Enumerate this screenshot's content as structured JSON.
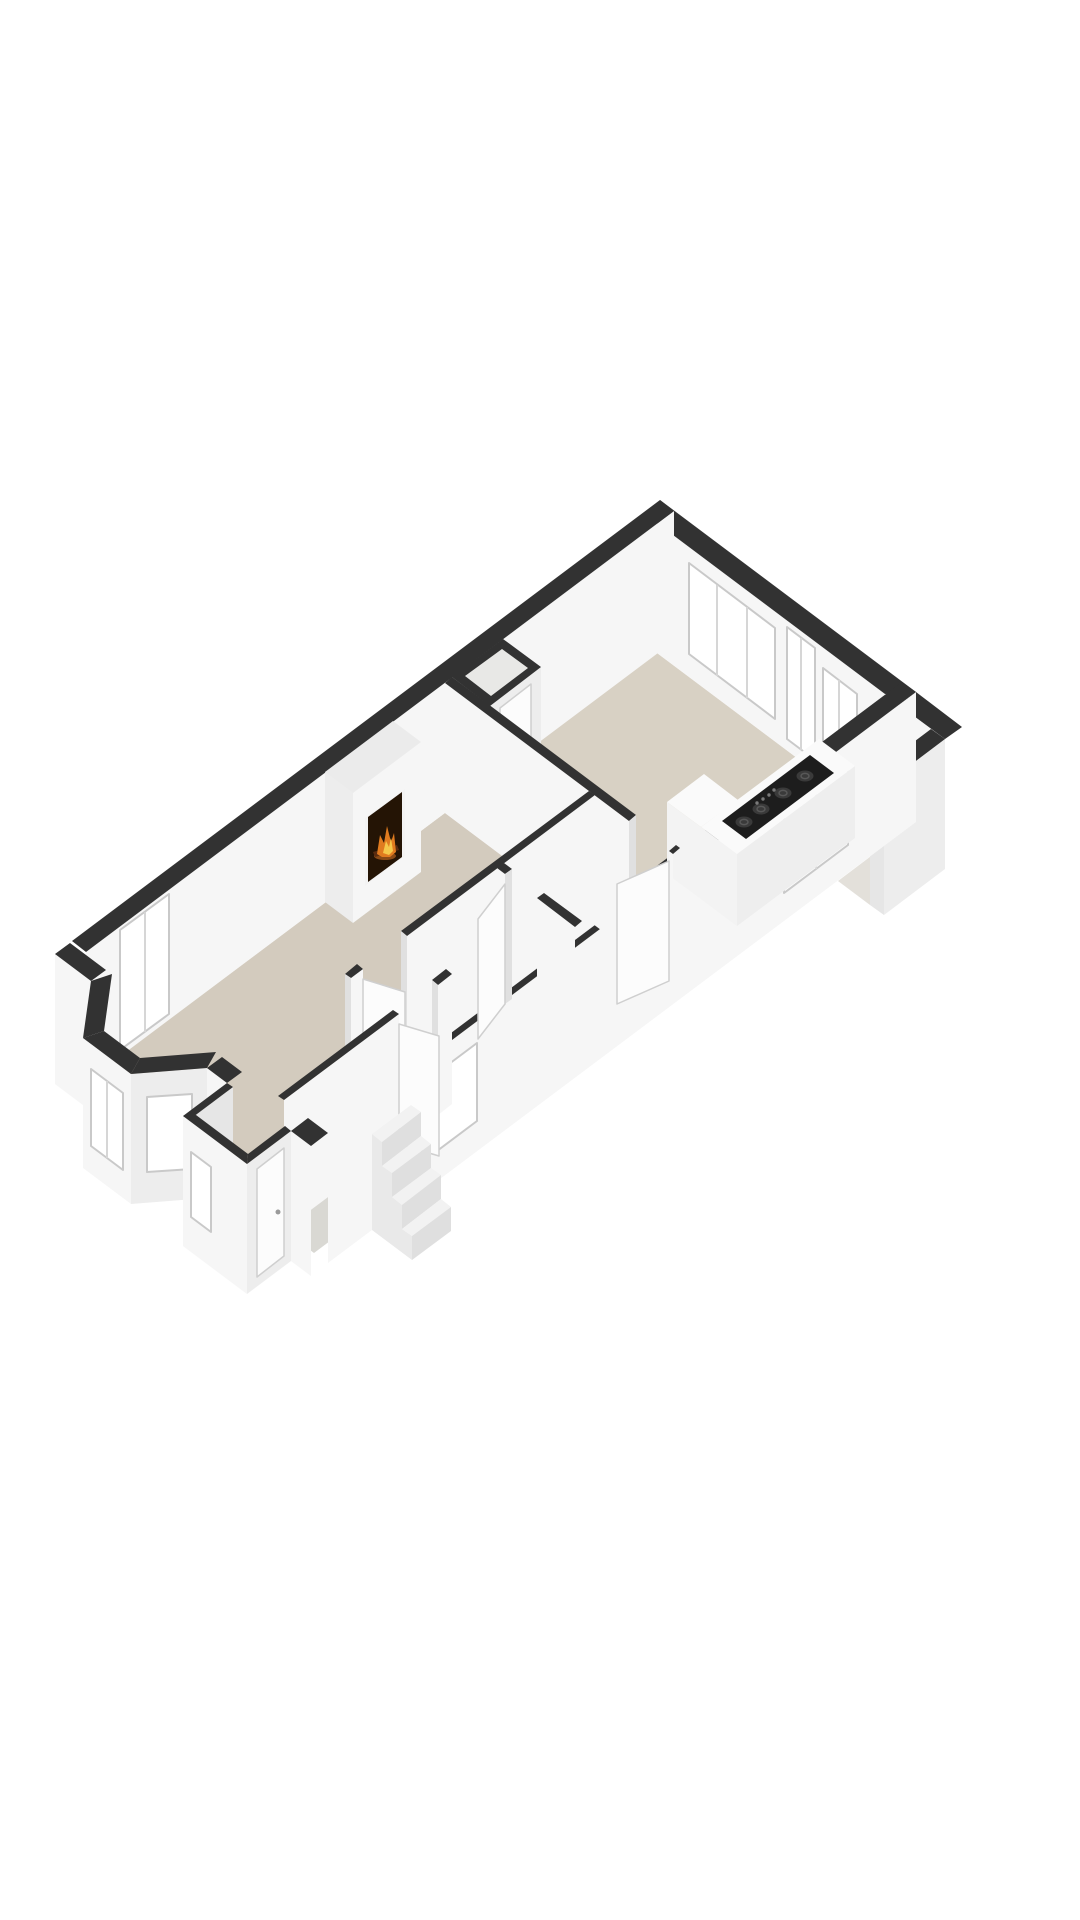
{
  "page": {
    "background": "#ffffff"
  },
  "colors": {
    "background": "#ffffff",
    "wall_cap": "#323232",
    "wall_face_light": "#f6f6f6",
    "wall_face_mid": "#ededed",
    "wall_face_shaded": "#e0e0e0",
    "wall_face_inner": "#e6e6e6",
    "floor_kitchen": "#d8d1c4",
    "floor_living": "#d3cbbe",
    "floor_hall": "#d9d8d3",
    "floor_porch": "#d5cec2",
    "floor_balcony": "#e3e0da",
    "closet_inner": "#e8e8e6",
    "glass": "#ffffff",
    "frame": "#c9c9c9",
    "mullion": "#d6d6d6",
    "door_leaf": "#fcfcfc",
    "door_edge": "#cfcfcf",
    "counter_top": "#fafafa",
    "counter_face": "#eeeeee",
    "counter_side": "#f3f3f3",
    "cooktop": "#1d1d1d",
    "burner": "#3a3a3a",
    "burner_ring": "#585858",
    "knob": "#7a7a7a",
    "fire_frame": "#f3f3f3",
    "fire_opening": "#241405",
    "log": "#5a2c10",
    "flame_orange": "#e07b1f",
    "flame_yellow": "#f5c84a",
    "ember": "#8a4a16",
    "handle": "#9a9a9a",
    "step_top": "#f2f2f2",
    "step_riser": "#dfdfdf",
    "step_side": "#e9e9e9"
  },
  "scene": {
    "type": "3d-floor-plan-render",
    "rooms": [
      "kitchen-dining",
      "living-room",
      "hallway",
      "entrance-hall",
      "closet",
      "porch",
      "balcony"
    ],
    "features": {
      "fireplace_lit": true,
      "cooktop_burners": 4,
      "cooktop_knobs": 4,
      "exterior_steps": 4,
      "bay_window_panes": 3,
      "ne_wall_windows": 2,
      "balcony_door": 1,
      "french_doors": 1,
      "interior_door_leaves": 3,
      "front_door": 1
    }
  }
}
